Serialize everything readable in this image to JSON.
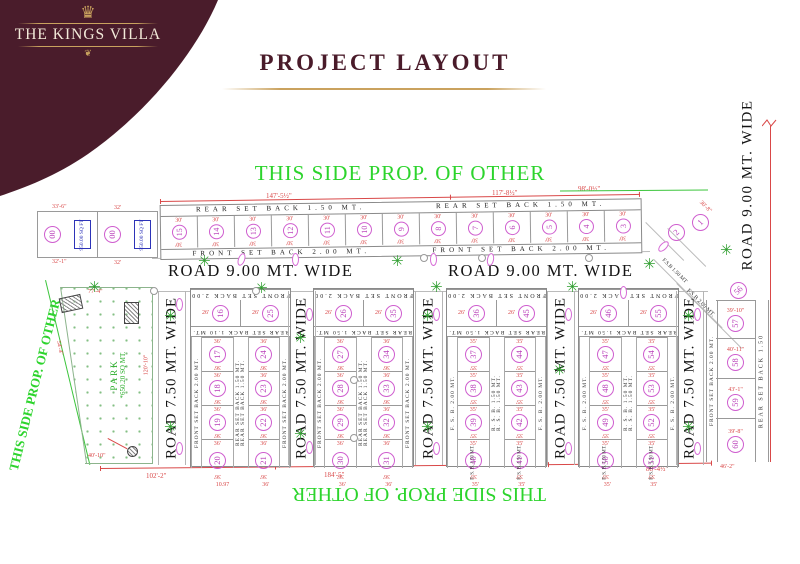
{
  "brand": {
    "name": "THE KINGS VILLA"
  },
  "icons": {
    "crown": "♛",
    "flourish": "❦",
    "tree": "✳"
  },
  "title": "PROJECT LAYOUT",
  "prop_labels": {
    "top": "THIS SIDE PROP. OF OTHER",
    "left": "THIS SIDE PROP. OF OTHER",
    "bottom": "THIS SIDE PROP. OF OTHER"
  },
  "roads": {
    "horizontal_left": "ROAD 9.00 MT. WIDE",
    "horizontal_right": "ROAD 9.00 MT. WIDE",
    "vertical_right": "ROAD 9.00 MT. WIDE",
    "vertical": "ROAD 7.50 MT. WIDE"
  },
  "setbacks": {
    "rear_top_row": "REAR SET BACK 1.50 MT.",
    "front_top_row": "FRONT SET BACK 2.00 MT.",
    "diag_fsb_150": "F.S.B 1.50 MT",
    "diag_fsb_200": "F.S.B 2.00 MT.",
    "fsb_150": "F. S. B. 1.50 MT."
  },
  "park": {
    "name": "PARK",
    "area": "*650.20 SQ MT.",
    "dim_top": "77'-4\"",
    "dim_right": "120'-10\"",
    "dim_bottom": "40'-10\"",
    "dim_left": "54'-4\""
  },
  "top_left_plots": [
    {
      "number": "00",
      "area_line1": "950.00",
      "area_line2": "SQ FT",
      "dim_top": "33'-6\"",
      "dim_bottom": "32'-1\""
    },
    {
      "number": "00",
      "area_line1": "950.00",
      "area_line2": "SQ FT",
      "dim_top": "32'",
      "dim_bottom": "32'"
    }
  ],
  "top_row": {
    "numbers": [
      "15",
      "14",
      "13",
      "12",
      "11",
      "10",
      "9",
      "8",
      "7",
      "6",
      "5",
      "4",
      "3"
    ],
    "dim": "30'"
  },
  "diagonal_plots": {
    "numbers": [
      "2",
      "1"
    ],
    "dim": "30'-8\""
  },
  "blocks": [
    {
      "top": "FRONT SET BACK 2.00 MT.",
      "rear": "REAR SET BACK 1.10 MT.",
      "center": "REAR SET BACK 1.50 MT.",
      "side": "FRONT SET BACK 2.00 MT.",
      "row1_dim": "26'",
      "dim": "36'",
      "left": [
        "16",
        "17",
        "18",
        "19",
        "20"
      ],
      "right": [
        "25",
        "24",
        "23",
        "22",
        "21"
      ],
      "bottom_dims": [
        "10.97",
        "36'"
      ]
    },
    {
      "top": "FRONT SET BACK 2.00 MT.",
      "rear": "REAR SET BACK 1.50 MT.",
      "center": "REAR SET BACK 1.50 MT.",
      "side": "FRONT SET BACK 2.00 MT.",
      "row1_dim": "26'",
      "dim": "36'",
      "left": [
        "26",
        "27",
        "28",
        "29",
        "30"
      ],
      "right": [
        "35",
        "34",
        "33",
        "32",
        "31"
      ],
      "bottom_dims": [
        "36'",
        "36'"
      ]
    },
    {
      "top": "FRONT SET BACK 2.00 MT.",
      "rear": "REAR SET BACK 1.50 MT.",
      "center": "R. S. B. 1.50 MT.",
      "side": "F. S. B. 2.00 MT.",
      "row1_dim": "26'",
      "dim": "35'",
      "left": [
        "36",
        "37",
        "38",
        "39",
        "40"
      ],
      "right": [
        "45",
        "44",
        "43",
        "42",
        "41"
      ],
      "bottom_dims": [
        "35'",
        "35'"
      ],
      "fsb": "F. S. B. 1.50 MT."
    },
    {
      "top": "FRONT SET BACK 2.00 MT.",
      "rear": "REAR SET BACK 1.50 MT.",
      "center": "R. S. B. 1.50 MT.",
      "side": "F. S. B. 2.00 MT.",
      "row1_dim": "26'",
      "dim": "35'",
      "left": [
        "46",
        "47",
        "48",
        "49",
        "50"
      ],
      "right": [
        "55",
        "54",
        "53",
        "52",
        "51"
      ],
      "bottom_dims": [
        "35'",
        "35'"
      ],
      "fsb": "F. S. B. 1.50 MT."
    }
  ],
  "right_column": {
    "front_label": "FRONT SET BACK 2.00 MT.",
    "rear_label": "REAR SET BACK 1.50",
    "diagonal_number": "56",
    "numbers": [
      "57",
      "58",
      "59",
      "60"
    ],
    "dims": [
      "39'-10\"",
      "40'-11\"",
      "43'-1\"",
      "39'-8\""
    ],
    "bottom_dim": "46'-2\""
  },
  "dimensions": {
    "top_left_seg": "147'-5½\"",
    "top_right_seg": "117'-8½\"",
    "right_top": "98'-0½\"",
    "bottom_left": "102'-2\"",
    "bottom_mid": "184'-5\"",
    "bottom_right": "88'-4½\""
  },
  "colors": {
    "maroon": "#4a1c2b",
    "gold": "#c9a25e",
    "green": "#2cd42c",
    "red": "#d94848",
    "pink": "#cf5ecf",
    "blue": "#2d33b8"
  }
}
